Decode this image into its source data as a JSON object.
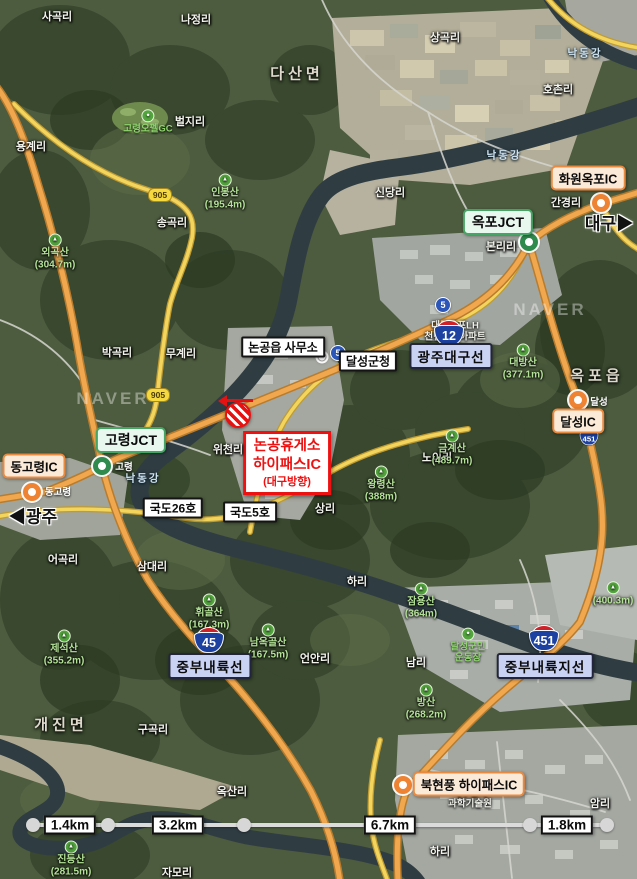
{
  "canvas": {
    "width": 637,
    "height": 879
  },
  "watermarks": [
    {
      "text": "NAVER",
      "x": 113,
      "y": 399
    },
    {
      "text": "NAVER",
      "x": 550,
      "y": 310
    }
  ],
  "base_labels": {
    "villages": [
      {
        "text": "사곡리",
        "x": 57,
        "y": 16
      },
      {
        "text": "나정리",
        "x": 196,
        "y": 19
      },
      {
        "text": "상곡리",
        "x": 445,
        "y": 37
      },
      {
        "text": "호촌리",
        "x": 558,
        "y": 89
      },
      {
        "text": "벌지리",
        "x": 190,
        "y": 121
      },
      {
        "text": "용계리",
        "x": 31,
        "y": 146
      },
      {
        "text": "송곡리",
        "x": 172,
        "y": 222
      },
      {
        "text": "신당리",
        "x": 390,
        "y": 192
      },
      {
        "text": "간경리",
        "x": 566,
        "y": 202
      },
      {
        "text": "본리리",
        "x": 501,
        "y": 246
      },
      {
        "text": "박곡리",
        "x": 117,
        "y": 352
      },
      {
        "text": "무계리",
        "x": 181,
        "y": 353
      },
      {
        "text": "위천리",
        "x": 228,
        "y": 449
      },
      {
        "text": "노이리",
        "x": 437,
        "y": 457
      },
      {
        "text": "상리",
        "x": 325,
        "y": 508
      },
      {
        "text": "삼대리",
        "x": 152,
        "y": 566
      },
      {
        "text": "어곡리",
        "x": 63,
        "y": 559
      },
      {
        "text": "하리",
        "x": 357,
        "y": 581
      },
      {
        "text": "언안리",
        "x": 315,
        "y": 658
      },
      {
        "text": "남리",
        "x": 416,
        "y": 662
      },
      {
        "text": "구곡리",
        "x": 153,
        "y": 729
      },
      {
        "text": "옥산리",
        "x": 232,
        "y": 791
      },
      {
        "text": "자모리",
        "x": 177,
        "y": 872
      },
      {
        "text": "암리",
        "x": 600,
        "y": 803
      },
      {
        "text": "하리",
        "x": 440,
        "y": 851
      }
    ],
    "towns": [
      {
        "text": "다산면",
        "x": 297,
        "y": 73
      },
      {
        "text": "옥포읍",
        "x": 597,
        "y": 375
      },
      {
        "text": "개진면",
        "x": 61,
        "y": 724
      }
    ],
    "rivers": [
      {
        "text": "낙동강",
        "x": 585,
        "y": 53
      },
      {
        "text": "낙동강",
        "x": 504,
        "y": 155
      },
      {
        "text": "낙동강",
        "x": 143,
        "y": 478
      }
    ],
    "mountains": [
      {
        "name": "인봉산",
        "elev": "(195.4m)",
        "x": 225,
        "y": 192
      },
      {
        "name": "외곡산",
        "elev": "(304.7m)",
        "x": 55,
        "y": 252
      },
      {
        "name": "대방산",
        "elev": "(377.1m)",
        "x": 523,
        "y": 362
      },
      {
        "name": "금계산",
        "elev": "(489.7m)",
        "x": 452,
        "y": 448
      },
      {
        "name": "왕령산",
        "elev": "(388m)",
        "x": 381,
        "y": 484
      },
      {
        "name": "휘골산",
        "elev": "(167.3m)",
        "x": 209,
        "y": 612
      },
      {
        "name": "남옥골산",
        "elev": "(167.5m)",
        "x": 268,
        "y": 642
      },
      {
        "name": "잠용산",
        "elev": "(364m)",
        "x": 421,
        "y": 601
      },
      {
        "name": "방산",
        "elev": "(268.2m)",
        "x": 426,
        "y": 702
      },
      {
        "name": "진등산",
        "elev": "(281.5m)",
        "x": 71,
        "y": 859
      },
      {
        "name": "제석산",
        "elev": "(355.2m)",
        "x": 64,
        "y": 648
      },
      {
        "name": "",
        "elev": "(400.3m)",
        "x": 613,
        "y": 594
      }
    ],
    "pois_green": [
      {
        "lines": [
          "고령오펠GC"
        ],
        "x": 148,
        "y": 122
      },
      {
        "lines": [
          "달성군민",
          "운동장"
        ],
        "x": 468,
        "y": 646
      }
    ],
    "pois_white": [
      {
        "lines": [
          "대구옥포LH",
          "천년나무아파트"
        ],
        "x": 455,
        "y": 332
      },
      {
        "lines": [
          "대구경북",
          "과학기술원"
        ],
        "x": 470,
        "y": 799
      }
    ],
    "tiny": [
      {
        "text": "고령",
        "x": 124,
        "y": 466
      },
      {
        "text": "달성",
        "x": 599,
        "y": 401
      },
      {
        "text": "동고령",
        "x": 58,
        "y": 491
      }
    ]
  },
  "shields": {
    "expressway": [
      {
        "num": "12",
        "x": 449,
        "y": 333,
        "s": 1
      },
      {
        "num": "45",
        "x": 209,
        "y": 640,
        "s": 1
      },
      {
        "num": "451",
        "x": 544,
        "y": 638,
        "s": 1
      },
      {
        "num": "451",
        "x": 589,
        "y": 437,
        "s": 0.62
      }
    ],
    "national": [
      {
        "num": "5",
        "x": 338,
        "y": 353
      },
      {
        "num": "5",
        "x": 443,
        "y": 305
      }
    ],
    "local": [
      {
        "num": "905",
        "x": 160,
        "y": 195
      },
      {
        "num": "905",
        "x": 158,
        "y": 395
      }
    ]
  },
  "annotations": {
    "jct_boxes": [
      {
        "label": "옥포JCT",
        "x": 498,
        "y": 222,
        "mx": 529,
        "my": 242
      },
      {
        "label": "고령JCT",
        "x": 131,
        "y": 440,
        "mx": 102,
        "my": 466
      }
    ],
    "ic_boxes": [
      {
        "label": "화원옥포IC",
        "x": 588,
        "y": 178,
        "mx": 601,
        "my": 203
      },
      {
        "label": "동고령IC",
        "x": 34,
        "y": 466,
        "mx": 32,
        "my": 492
      },
      {
        "label": "달성IC",
        "x": 578,
        "y": 421,
        "mx": 578,
        "my": 400
      },
      {
        "label": "북현풍 하이패스IC",
        "x": 469,
        "y": 784,
        "mx": 403,
        "my": 785
      }
    ],
    "route_boxes": [
      {
        "label": "광주대구선",
        "x": 451,
        "y": 356
      },
      {
        "label": "중부내륙선",
        "x": 210,
        "y": 666
      },
      {
        "label": "중부내륙지선",
        "x": 545,
        "y": 666
      }
    ],
    "plain_boxes": [
      {
        "label": "논공읍 사무소",
        "x": 283,
        "y": 347
      },
      {
        "label": "달성군청",
        "x": 368,
        "y": 361
      },
      {
        "label": "국도26호",
        "x": 173,
        "y": 508
      },
      {
        "label": "국도5호",
        "x": 250,
        "y": 512
      }
    ],
    "direction_labels": [
      {
        "text": "◀광주",
        "x": 33,
        "y": 515
      },
      {
        "text": "대구▶",
        "x": 609,
        "y": 222
      }
    ],
    "highlight_box": {
      "lines": [
        "논공휴게소",
        "하이패스IC",
        "(대구방향)"
      ],
      "x": 287,
      "y": 463,
      "marker_x": 238,
      "marker_y": 415
    },
    "office_dot": {
      "x": 322,
      "y": 357
    }
  },
  "scale_bar": {
    "y": 825,
    "x_start": 33,
    "x_end": 607,
    "nodes": [
      33,
      108,
      244,
      530,
      607
    ],
    "labels": [
      {
        "text": "1.4km",
        "x": 70
      },
      {
        "text": "3.2km",
        "x": 178
      },
      {
        "text": "6.7km",
        "x": 390
      },
      {
        "text": "1.8km",
        "x": 567
      }
    ]
  }
}
